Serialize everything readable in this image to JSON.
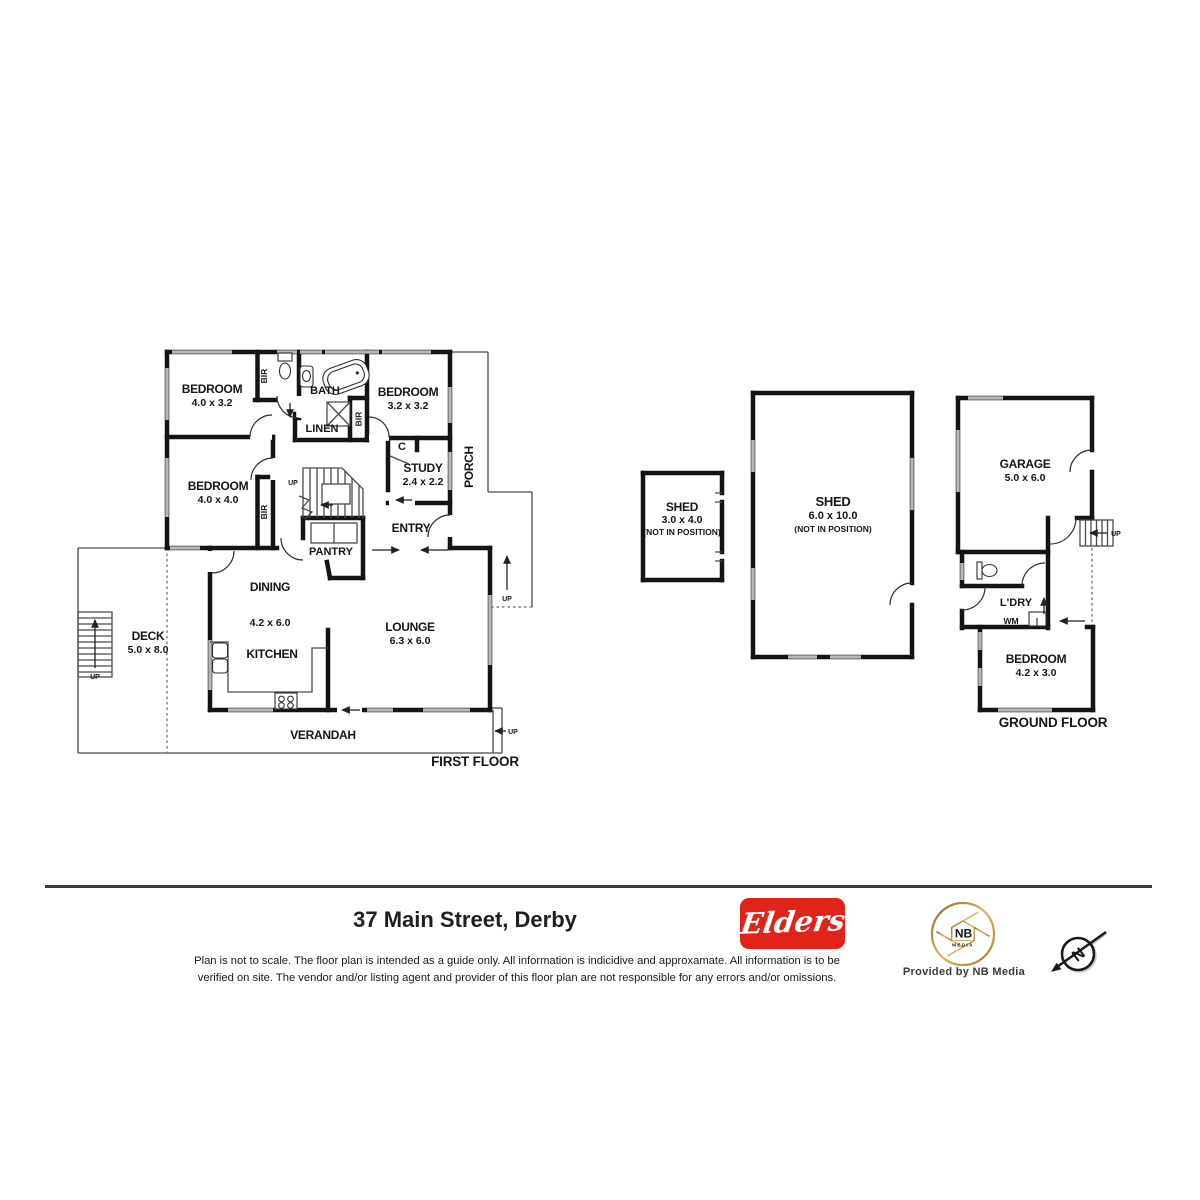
{
  "first_floor": {
    "floor_label": "FIRST FLOOR",
    "bedroom1": {
      "name": "BEDROOM",
      "dims": "4.0 x 3.2"
    },
    "bedroom2": {
      "name": "BEDROOM",
      "dims": "3.2 x 3.2"
    },
    "bedroom3": {
      "name": "BEDROOM",
      "dims": "4.0 x 4.0"
    },
    "bath": "BATH",
    "linen": "LINEN",
    "study": {
      "name": "STUDY",
      "dims": "2.4 x 2.2"
    },
    "cupboard": "C",
    "porch": "PORCH",
    "entry": "ENTRY",
    "pantry": "PANTRY",
    "dining": {
      "name": "DINING",
      "dims": "4.2 x 6.0"
    },
    "kitchen": "KITCHEN",
    "lounge": {
      "name": "LOUNGE",
      "dims": "6.3 x 6.0"
    },
    "deck": {
      "name": "DECK",
      "dims": "5.0 x 8.0"
    },
    "verandah": "VERANDAH",
    "bir": "BIR",
    "up": "UP"
  },
  "outbuildings": {
    "shed_small": {
      "name": "SHED",
      "dims": "3.0 x 4.0",
      "note": "(NOT IN POSITION)"
    },
    "shed_large": {
      "name": "SHED",
      "dims": "6.0 x 10.0",
      "note": "(NOT IN POSITION)"
    }
  },
  "ground_floor": {
    "floor_label": "GROUND FLOOR",
    "garage": {
      "name": "GARAGE",
      "dims": "5.0 x 6.0"
    },
    "laundry": "L'DRY",
    "wm": "WM",
    "bedroom": {
      "name": "BEDROOM",
      "dims": "4.2 x 3.0"
    },
    "up": "UP"
  },
  "footer": {
    "address": "37 Main Street, Derby",
    "disclaimer_line1": "Plan is not to scale. The floor plan is intended as a guide only. All information is indicidive and approxamate. All information is to be",
    "disclaimer_line2": "verified on site. The vendor and/or listing agent and provider of this floor plan are not responsible for any errors and/or omissions.",
    "elders_logo": "Elders",
    "nb_logo": {
      "initials": "NB",
      "media": "MEDIA",
      "provided": "Provided by NB Media"
    },
    "compass_n": "N",
    "colors": {
      "elders_red": "#e2231a",
      "nb_gold": "#c69c45"
    }
  }
}
